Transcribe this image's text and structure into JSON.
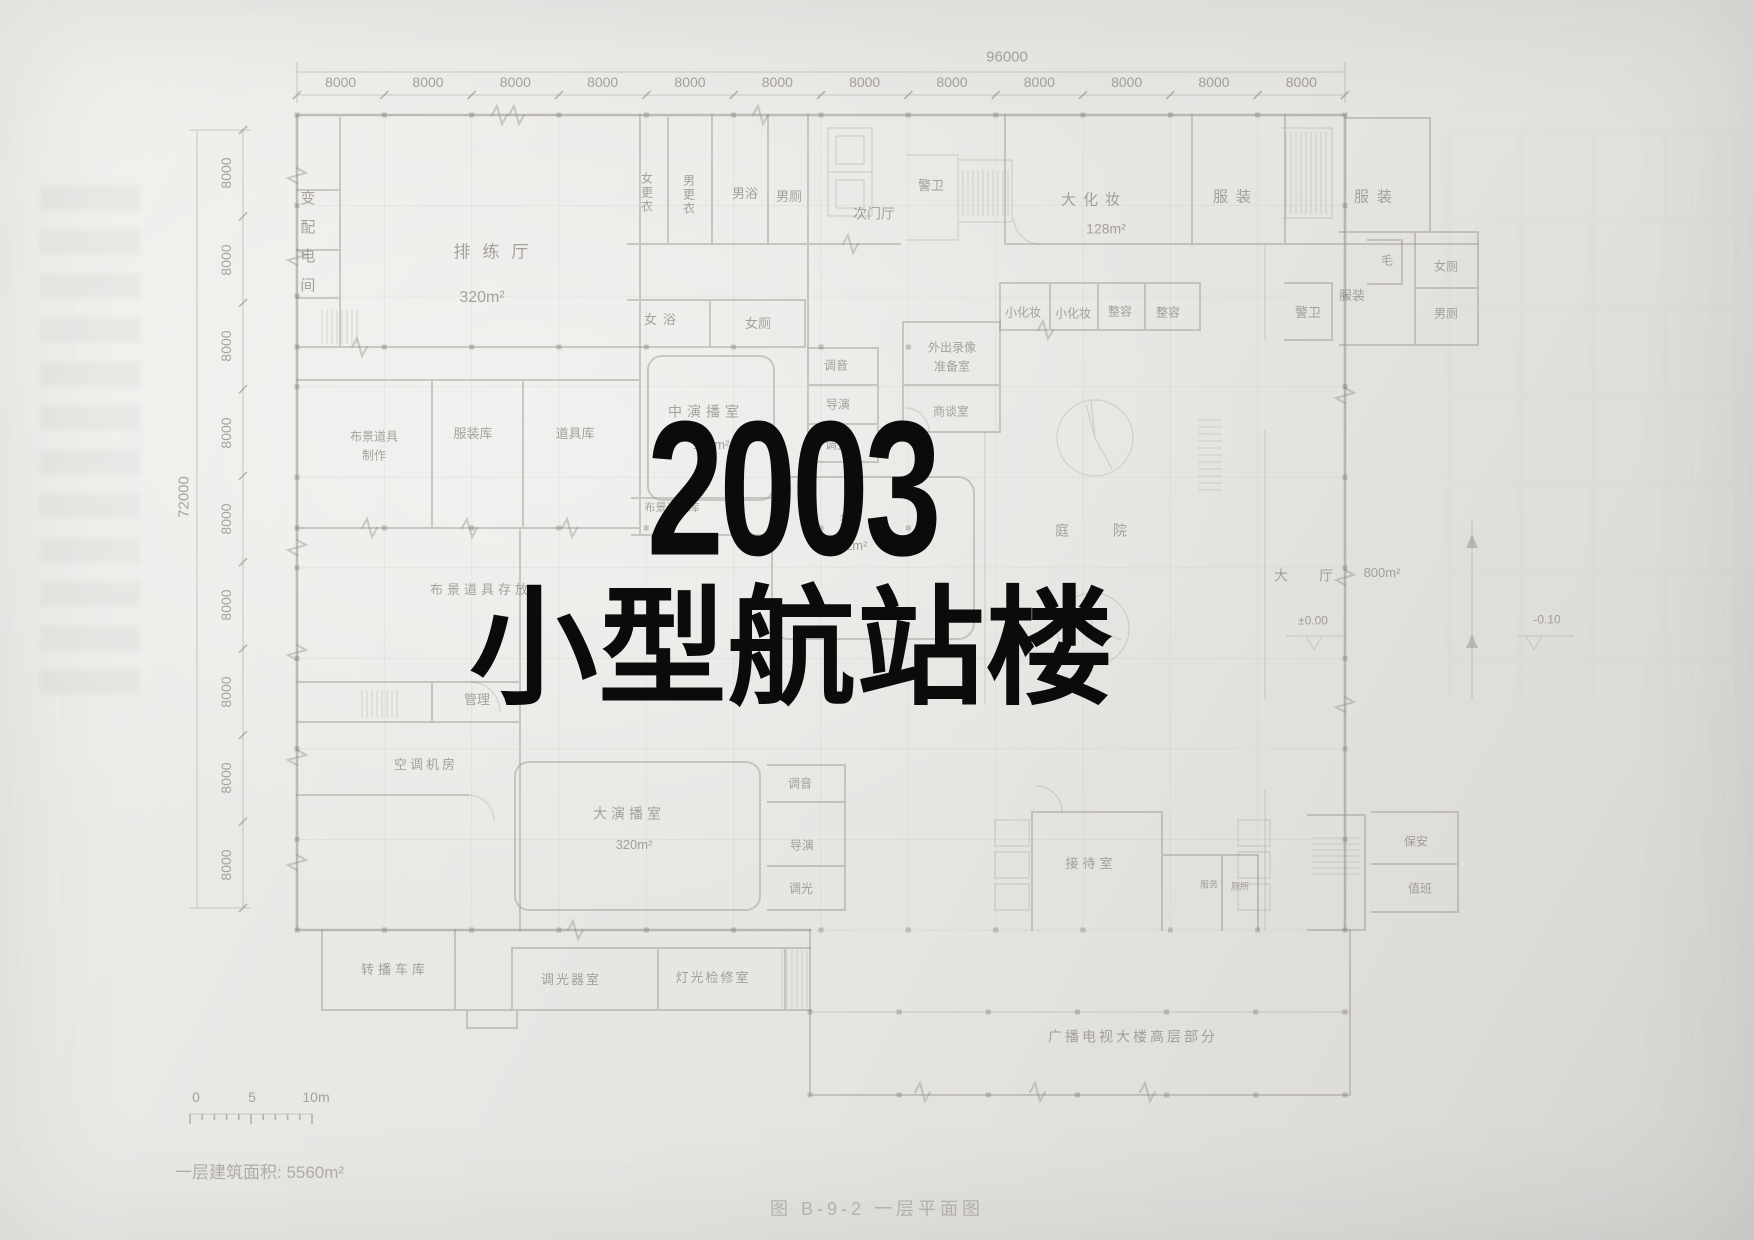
{
  "title": {
    "line1": "2003",
    "line2": "小型航站楼"
  },
  "plan": {
    "figure_caption": "图 B-9-2  一层平面图",
    "area_note": "一层建筑面积: 5560m²",
    "scale_bar": {
      "t0": "0",
      "t5": "5",
      "t10": "10m"
    },
    "dimensions": {
      "top_total": "96000",
      "top_bay": "8000",
      "top_bay_count": 12,
      "left_total": "72000",
      "left_bay": "8000",
      "left_bay_count": 9
    },
    "levels": {
      "hall": "±0.00",
      "outdoor": "-0.10"
    },
    "labels": [
      {
        "t": "变配电间",
        "x": 306,
        "y": 248,
        "v": 1,
        "fs": 15,
        "ls": 14
      },
      {
        "t": "排练厅",
        "x": 497,
        "y": 252,
        "fs": 17,
        "ls": 12
      },
      {
        "t": "320m²",
        "x": 482,
        "y": 298,
        "fs": 16
      },
      {
        "t": "女更衣",
        "x": 646,
        "y": 193,
        "v": 1,
        "fs": 12,
        "ls": 2
      },
      {
        "t": "男更衣",
        "x": 688,
        "y": 195,
        "v": 1,
        "fs": 12,
        "ls": 2
      },
      {
        "t": "男浴",
        "x": 745,
        "y": 194,
        "fs": 13
      },
      {
        "t": "男厕",
        "x": 789,
        "y": 197,
        "fs": 13
      },
      {
        "t": "次门厅",
        "x": 874,
        "y": 214,
        "fs": 14
      },
      {
        "t": "警卫",
        "x": 931,
        "y": 186,
        "fs": 13
      },
      {
        "t": "大化妆",
        "x": 1094,
        "y": 201,
        "fs": 15,
        "ls": 7
      },
      {
        "t": "128m²",
        "x": 1106,
        "y": 229,
        "fs": 14
      },
      {
        "t": "服装",
        "x": 1236,
        "y": 198,
        "fs": 15,
        "ls": 8
      },
      {
        "t": "服装",
        "x": 1377,
        "y": 198,
        "fs": 15,
        "ls": 8
      },
      {
        "t": "毛",
        "x": 1387,
        "y": 261,
        "fs": 12
      },
      {
        "t": "女厕",
        "x": 1446,
        "y": 267,
        "fs": 12
      },
      {
        "t": "男厕",
        "x": 1446,
        "y": 314,
        "fs": 12
      },
      {
        "t": "服装",
        "x": 1352,
        "y": 296,
        "fs": 13
      },
      {
        "t": "警卫",
        "x": 1308,
        "y": 313,
        "fs": 13
      },
      {
        "t": "小化妆",
        "x": 1023,
        "y": 313,
        "fs": 12
      },
      {
        "t": "小化妆",
        "x": 1073,
        "y": 314,
        "fs": 12
      },
      {
        "t": "整容",
        "x": 1120,
        "y": 312,
        "fs": 12
      },
      {
        "t": "整容",
        "x": 1168,
        "y": 313,
        "fs": 12
      },
      {
        "t": "女浴",
        "x": 663,
        "y": 320,
        "fs": 13,
        "ls": 6
      },
      {
        "t": "女厕",
        "x": 758,
        "y": 324,
        "fs": 13
      },
      {
        "t": "调音",
        "x": 836,
        "y": 366,
        "fs": 12
      },
      {
        "t": "导演",
        "x": 838,
        "y": 405,
        "fs": 12
      },
      {
        "t": "调光",
        "x": 837,
        "y": 445,
        "fs": 12
      },
      {
        "t": "外出录像\n准备室",
        "x": 952,
        "y": 357,
        "fs": 12,
        "pre": 1
      },
      {
        "t": "商谈室",
        "x": 951,
        "y": 412,
        "fs": 12
      },
      {
        "t": "中演播室",
        "x": 706,
        "y": 412,
        "fs": 14,
        "ls": 5
      },
      {
        "t": "192m²",
        "x": 711,
        "y": 445,
        "fs": 13
      },
      {
        "t": "布景道具\n制作",
        "x": 374,
        "y": 446,
        "fs": 12,
        "pre": 1
      },
      {
        "t": "服装库",
        "x": 473,
        "y": 434,
        "fs": 13
      },
      {
        "t": "道具库",
        "x": 575,
        "y": 434,
        "fs": 13
      },
      {
        "t": "布景道具库",
        "x": 672,
        "y": 509,
        "fs": 11
      },
      {
        "t": "播",
        "x": 846,
        "y": 520,
        "fs": 12
      },
      {
        "t": "192m²",
        "x": 849,
        "y": 546,
        "fs": 13
      },
      {
        "t": "庭",
        "x": 1062,
        "y": 531,
        "fs": 14
      },
      {
        "t": "院",
        "x": 1120,
        "y": 531,
        "fs": 14
      },
      {
        "t": "布景道具存放",
        "x": 481,
        "y": 590,
        "fs": 13,
        "ls": 4
      },
      {
        "t": "管理",
        "x": 477,
        "y": 700,
        "fs": 13
      },
      {
        "t": "空调机房",
        "x": 426,
        "y": 765,
        "fs": 13,
        "ls": 3
      },
      {
        "t": "大演播室",
        "x": 629,
        "y": 814,
        "fs": 14,
        "ls": 4
      },
      {
        "t": "320m²",
        "x": 634,
        "y": 845,
        "fs": 13
      },
      {
        "t": "调音",
        "x": 800,
        "y": 784,
        "fs": 12
      },
      {
        "t": "导演",
        "x": 802,
        "y": 846,
        "fs": 12
      },
      {
        "t": "调光",
        "x": 801,
        "y": 889,
        "fs": 12
      },
      {
        "t": "大",
        "x": 1281,
        "y": 576,
        "fs": 14
      },
      {
        "t": "厅",
        "x": 1326,
        "y": 576,
        "fs": 14
      },
      {
        "t": "800m²",
        "x": 1382,
        "y": 573,
        "fs": 13
      },
      {
        "t": "±0.00",
        "x": 1313,
        "y": 621,
        "fs": 12,
        "n": "level-marker-label"
      },
      {
        "t": "-0.10",
        "x": 1547,
        "y": 620,
        "fs": 12,
        "n": "level-marker-label"
      },
      {
        "t": "转播车库",
        "x": 395,
        "y": 970,
        "fs": 13,
        "ls": 4
      },
      {
        "t": "调光器室",
        "x": 571,
        "y": 980,
        "fs": 13,
        "ls": 2
      },
      {
        "t": "灯光检修室",
        "x": 713,
        "y": 978,
        "fs": 13,
        "ls": 2
      },
      {
        "t": "接待室",
        "x": 1091,
        "y": 864,
        "fs": 13,
        "ls": 4
      },
      {
        "t": "服务",
        "x": 1209,
        "y": 885,
        "fs": 9
      },
      {
        "t": "厕所",
        "x": 1240,
        "y": 887,
        "fs": 9
      },
      {
        "t": "保安",
        "x": 1416,
        "y": 842,
        "fs": 12
      },
      {
        "t": "值班",
        "x": 1420,
        "y": 889,
        "fs": 12
      },
      {
        "t": "广播电视大楼高层部分",
        "x": 1133,
        "y": 1037,
        "fs": 14,
        "ls": 3
      }
    ]
  },
  "colors": {
    "paper": "#e8e6e2",
    "title_ink": "#0b0b0b",
    "pencil": "#8f8c86"
  }
}
